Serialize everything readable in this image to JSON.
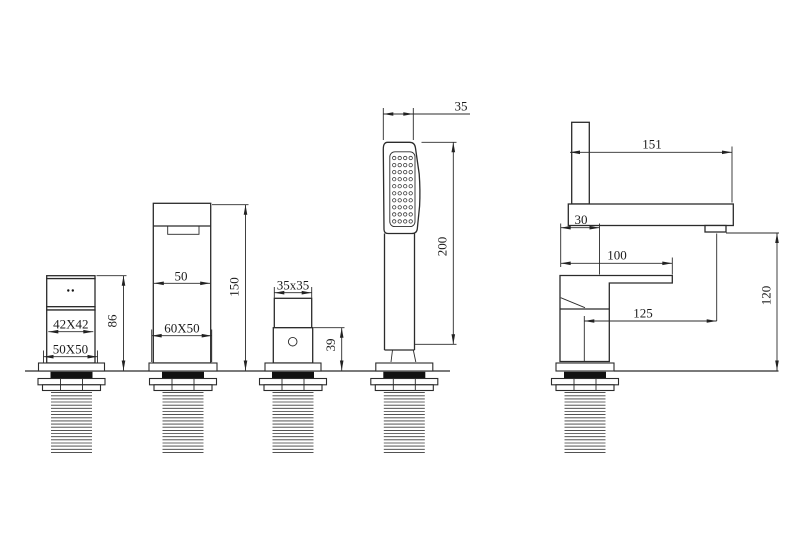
{
  "drawing": {
    "background": "#ffffff",
    "line_color": "#2b2b2b",
    "views": {
      "valve_front": {
        "dim_inner": "42X42",
        "dim_base": "50X50",
        "dim_height": "86"
      },
      "spout_front": {
        "dim_width": "50",
        "dim_base": "60X50",
        "dim_height": "150"
      },
      "handle_front": {
        "dim_size": "35x35",
        "dim_height": "39"
      },
      "hand_shower_front": {
        "dim_width": "35",
        "dim_height": "200",
        "nozzle_rows": 10,
        "nozzle_cols": 4
      },
      "mixer_side": {
        "dim_reach": "151",
        "dim_offset": "30",
        "dim_handle": "100",
        "dim_spout": "125",
        "dim_height": "120"
      }
    }
  }
}
